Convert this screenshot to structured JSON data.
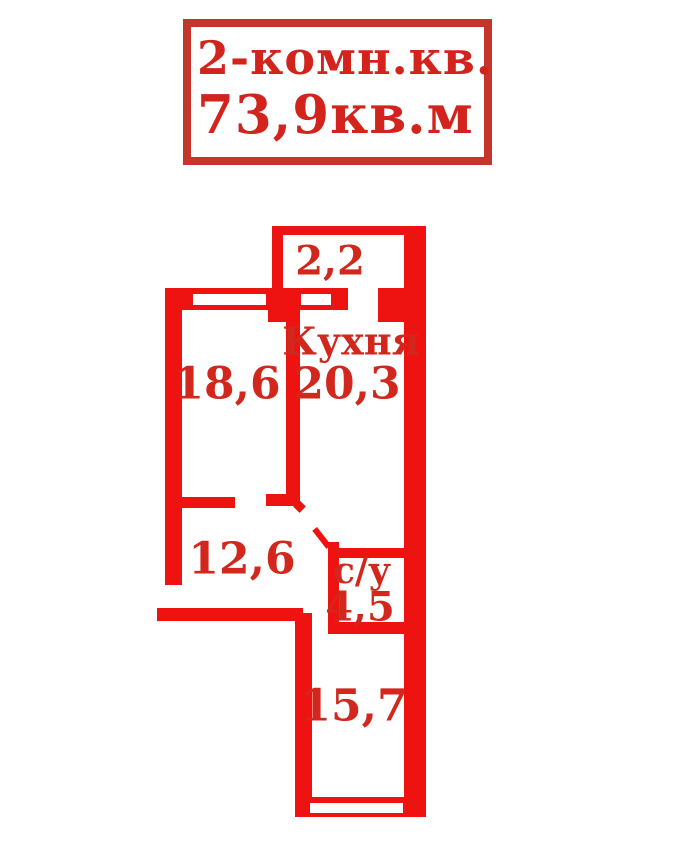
{
  "title": {
    "line1": "2-комн.кв.",
    "line2": "73,9кв.м"
  },
  "plan": {
    "balcony": {
      "area": "2,2"
    },
    "room1": {
      "area": "18,6"
    },
    "kitchen": {
      "name": "Кухня",
      "area": "20,3"
    },
    "hall": {
      "area": "12,6"
    },
    "bathroom": {
      "name": "с/у",
      "area": "4,5"
    },
    "room2": {
      "area": "15,7"
    }
  },
  "colors": {
    "wall": "#ee1310",
    "label": "#d2271d",
    "title_text": "#d2231c",
    "title_border": "#c5352b",
    "background": "#ffffff"
  }
}
